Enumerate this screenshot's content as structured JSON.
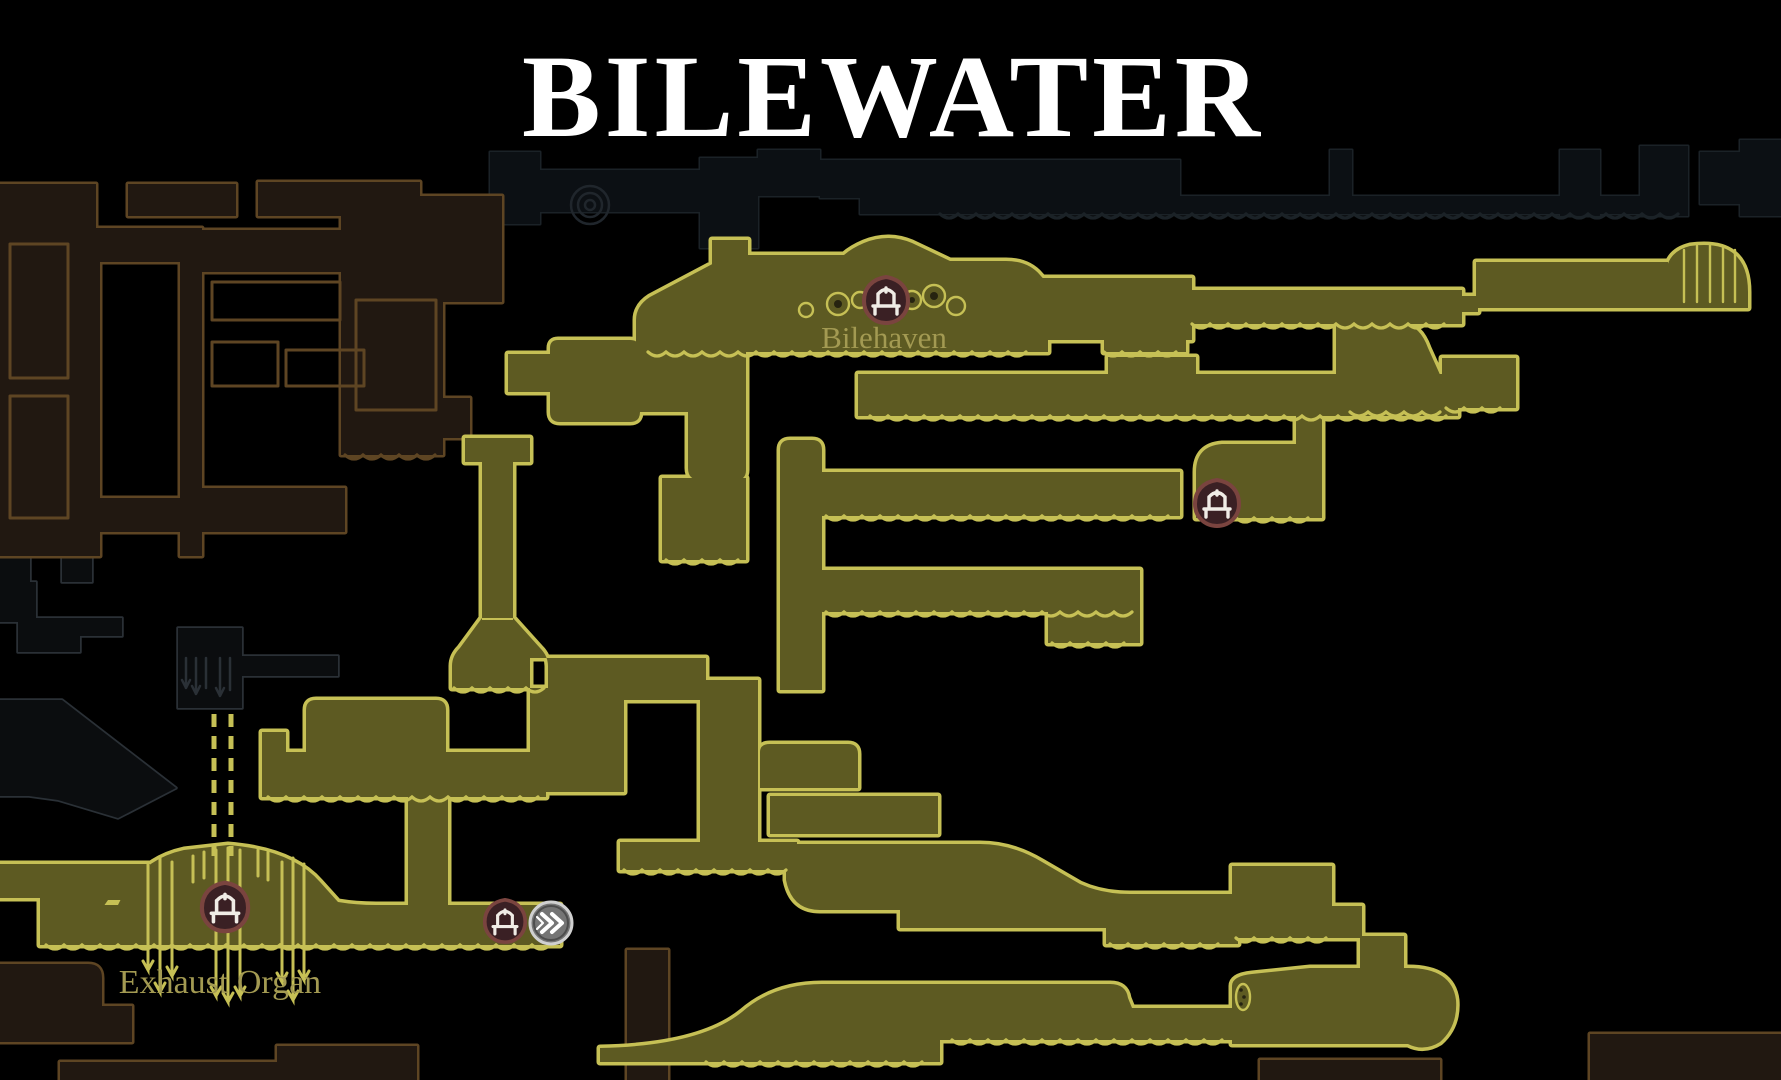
{
  "map": {
    "title": "BILEWATER",
    "areas": [
      {
        "id": "bilehaven",
        "label": "Bilehaven"
      },
      {
        "id": "exhaust_organ",
        "label": "Exhaust Organ"
      }
    ],
    "markers": {
      "bench_icon": "bench-icon",
      "tube_icon": "tube-station-icon",
      "bench_count": 4,
      "tube_count": 1
    },
    "colors": {
      "background": "#000000",
      "room_fill": "#5d5a22",
      "room_outline": "#c6c055",
      "unexplored_fill": "#211811",
      "unexplored_outline": "#5e4523",
      "silhouette_fill": "#0c1014",
      "silhouette_outline": "#1b2227",
      "ghost_fill": "#0b0d0f",
      "ghost_outline": "#2a3036",
      "title": "#ffffff",
      "label": "#a39a52",
      "bench_fill": "#3a2024",
      "bench_border": "#7a443f",
      "bench_glyph": "#f0ece6",
      "tube_fill": "#757575",
      "tube_border": "#d0d0d0",
      "tube_glyph": "#ffffff"
    }
  }
}
